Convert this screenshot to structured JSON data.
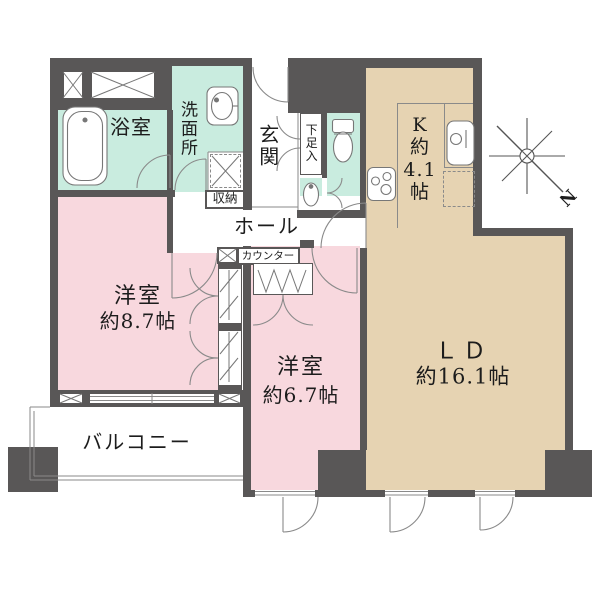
{
  "plan": {
    "compass": {
      "label": "N"
    },
    "colors": {
      "wall": "#595757",
      "wet_area_fill": "#c9ecdf",
      "bedroom_fill": "#f8d8de",
      "living_fill": "#e6d3b2"
    },
    "rooms": {
      "bathroom": {
        "label": "浴室"
      },
      "washroom": {
        "label": "洗面所"
      },
      "entrance": {
        "label": "玄関"
      },
      "shoe_box": {
        "label": "下足入"
      },
      "storage": {
        "label": "収納"
      },
      "hall": {
        "label": "ホール"
      },
      "counter": {
        "label": "カウンター"
      },
      "kitchen": {
        "label": "K\n約\n4.1\n帖"
      },
      "bedroom_8_7": {
        "name": "洋室",
        "size": "約8.7帖"
      },
      "bedroom_6_7": {
        "name": "洋室",
        "size": "約6.7帖"
      },
      "living_dining": {
        "name": "ＬＤ",
        "size": "約16.1帖"
      },
      "balcony": {
        "label": "バルコニー"
      }
    },
    "icons": [
      "bathtub-icon",
      "washbasin-icon",
      "toilet-icon",
      "hand-basin-icon",
      "kitchen-sink-icon",
      "stove-icon",
      "refrigerator-space",
      "compass-icon"
    ]
  }
}
